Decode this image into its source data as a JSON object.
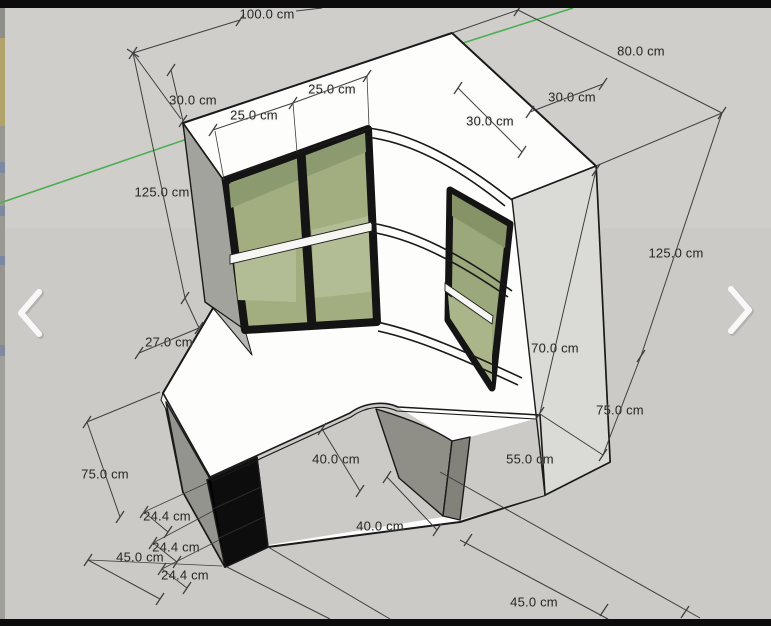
{
  "viewer": {
    "prev_icon": "chevron-left",
    "next_icon": "chevron-right"
  },
  "scene": {
    "type": "sketchup-3d-model",
    "unit": "cm",
    "dimension_labels": [
      {
        "text": "100.0 cm",
        "x": 267,
        "y": 14
      },
      {
        "text": "30.0 cm",
        "x": 193,
        "y": 100
      },
      {
        "text": "25.0 cm",
        "x": 254,
        "y": 115
      },
      {
        "text": "25.0 cm",
        "x": 332,
        "y": 89
      },
      {
        "text": "125.0 cm",
        "x": 162,
        "y": 192
      },
      {
        "text": "27.0 cm",
        "x": 169,
        "y": 342
      },
      {
        "text": "80.0 cm",
        "x": 641,
        "y": 51
      },
      {
        "text": "30.0 cm",
        "x": 490,
        "y": 121
      },
      {
        "text": "30.0 cm",
        "x": 572,
        "y": 97
      },
      {
        "text": "125.0 cm",
        "x": 676,
        "y": 253
      },
      {
        "text": "70.0 cm",
        "x": 555,
        "y": 348
      },
      {
        "text": "75.0 cm",
        "x": 620,
        "y": 410
      },
      {
        "text": "55.0 cm",
        "x": 530,
        "y": 459
      },
      {
        "text": "40.0 cm",
        "x": 336,
        "y": 459
      },
      {
        "text": "40.0 cm",
        "x": 380,
        "y": 526
      },
      {
        "text": "75.0 cm",
        "x": 105,
        "y": 474
      },
      {
        "text": "24.4 cm",
        "x": 167,
        "y": 516
      },
      {
        "text": "24.4 cm",
        "x": 176,
        "y": 547
      },
      {
        "text": "45.0 cm",
        "x": 140,
        "y": 557
      },
      {
        "text": "24.4 cm",
        "x": 185,
        "y": 575
      },
      {
        "text": "45.0 cm",
        "x": 534,
        "y": 602
      }
    ],
    "colors": {
      "background": "#cbcac6",
      "axis_green": "#4fae52",
      "face_white": "#fdfdfc",
      "face_gray_side": "#9e9e98",
      "face_panel": "#dadad6",
      "shelf_olive_light": "#aab58a",
      "shelf_olive_mid": "#9aa87b",
      "shelf_olive_dark": "#86956b",
      "frame_black": "#141414",
      "dimension_line": "#3f3f3f",
      "letterbox": "#0c0c0c",
      "nav_chevron": "#f8f8f8"
    }
  }
}
